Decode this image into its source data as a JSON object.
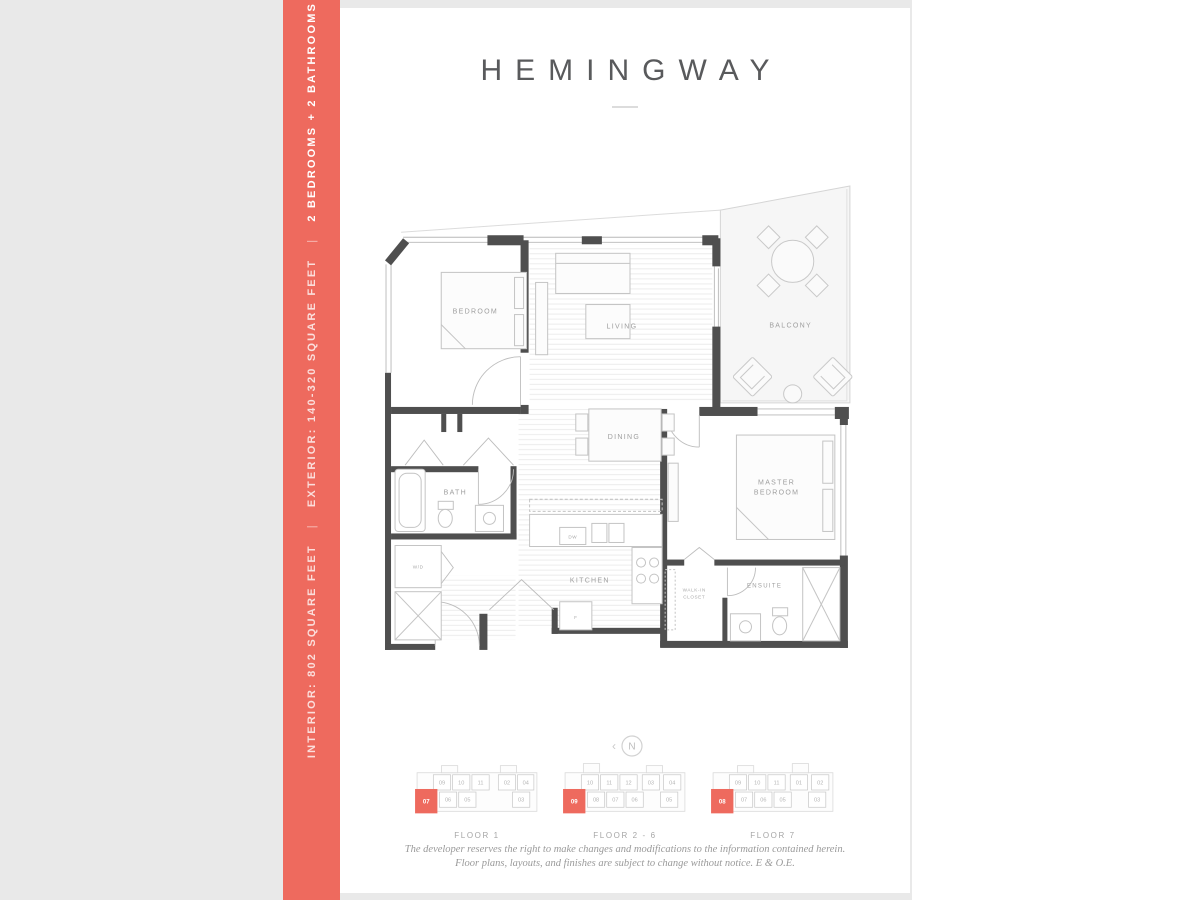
{
  "colors": {
    "accent": "#ee6a5e",
    "backdrop": "#e9e9e9",
    "page": "#ffffff",
    "wall": "#4f4f4f"
  },
  "sidebar": {
    "interior": "INTERIOR: 802 SQUARE FEET",
    "separator": "|",
    "exterior": "EXTERIOR: 140-320 SQUARE FEET",
    "bed_bath": "2 BEDROOMS + 2 BATHROOMS"
  },
  "header": {
    "title": "HEMINGWAY"
  },
  "plan": {
    "labels": {
      "bedroom": "BEDROOM",
      "living": "LIVING",
      "balcony": "BALCONY",
      "dining": "DINING",
      "bath": "BATH",
      "washer_dryer": "W/D",
      "kitchen": "KITCHEN",
      "dishwasher": "DW",
      "fridge": "F",
      "master_1": "MASTER",
      "master_2": "BEDROOM",
      "walkin_1": "WALK-IN",
      "walkin_2": "CLOSET",
      "ensuite": "ENSUITE"
    }
  },
  "compass": {
    "letter": "N",
    "arrow": "‹"
  },
  "key_plans": [
    {
      "label": "FLOOR 1",
      "highlight_unit": "07",
      "top_units": [
        "09",
        "10",
        "11",
        "02",
        "04"
      ],
      "bottom_units": [
        "06",
        "05",
        "03"
      ]
    },
    {
      "label": "FLOOR 2 - 6",
      "highlight_unit": "09",
      "top_units": [
        "10",
        "11",
        "12",
        "03",
        "04"
      ],
      "bottom_units": [
        "08",
        "07",
        "06",
        "05"
      ]
    },
    {
      "label": "FLOOR 7",
      "highlight_unit": "08",
      "top_units": [
        "09",
        "10",
        "11",
        "01",
        "02"
      ],
      "bottom_units": [
        "07",
        "06",
        "05",
        "03"
      ]
    }
  ],
  "disclaimer": {
    "line1": "The developer reserves the right to make changes and modifications to the information contained herein.",
    "line2": "Floor plans, layouts, and finishes are subject to change without notice. E & O.E."
  }
}
